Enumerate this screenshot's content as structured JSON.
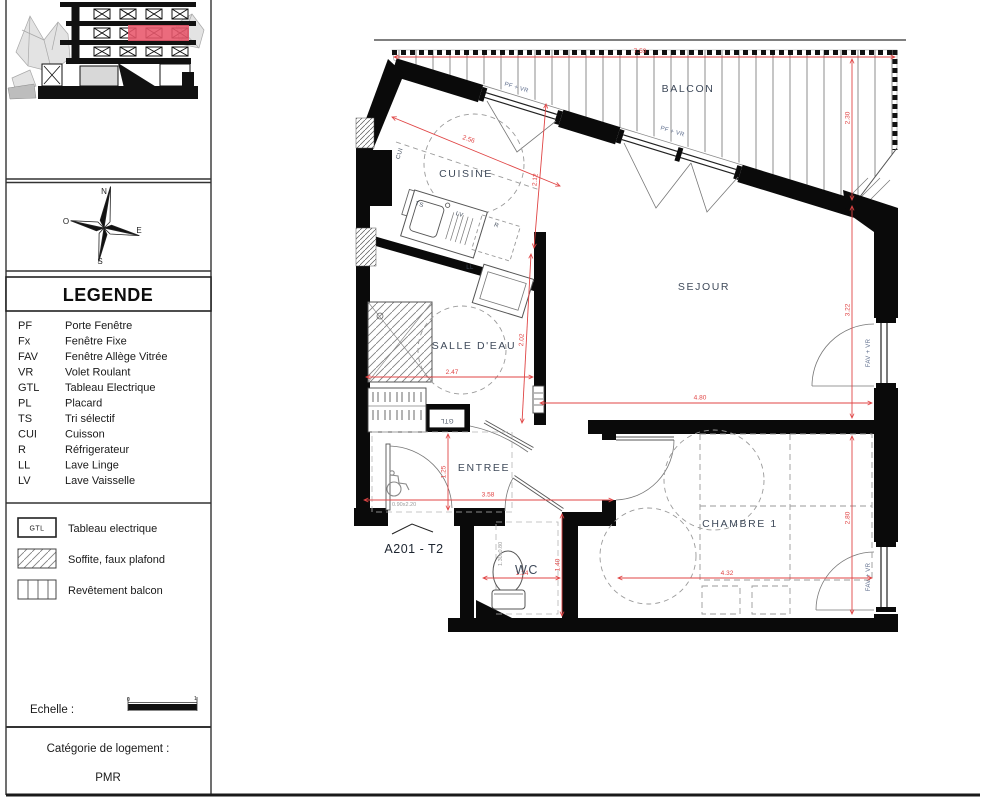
{
  "sidebar": {
    "compass": {
      "n": "N",
      "e": "E",
      "s": "S",
      "o": "O"
    },
    "legend": {
      "title": "LEGENDE",
      "items": [
        {
          "abbr": "PF",
          "label": "Porte Fenêtre"
        },
        {
          "abbr": "Fx",
          "label": "Fenêtre Fixe"
        },
        {
          "abbr": "FAV",
          "label": "Fenêtre Allège Vitrée"
        },
        {
          "abbr": "VR",
          "label": "Volet Roulant"
        },
        {
          "abbr": "GTL",
          "label": "Tableau Electrique"
        },
        {
          "abbr": "PL",
          "label": "Placard"
        },
        {
          "abbr": "TS",
          "label": "Tri sélectif"
        },
        {
          "abbr": "CUI",
          "label": "Cuisson"
        },
        {
          "abbr": "R",
          "label": "Réfrigerateur"
        },
        {
          "abbr": "LL",
          "label": "Lave Linge"
        },
        {
          "abbr": "LV",
          "label": "Lave Vaisselle"
        }
      ],
      "symbols": [
        {
          "key": "GTL",
          "label": "Tableau electrique"
        },
        {
          "key": "hatch",
          "label": "Soffite, faux plafond"
        },
        {
          "key": "stripes",
          "label": "Revêtement balcon"
        }
      ]
    },
    "scale": {
      "label": "Echelle :",
      "tick_start": "0",
      "tick_end": "1"
    },
    "category": {
      "label": "Catégorie de logement :",
      "value": "PMR"
    }
  },
  "plan": {
    "unit": "A201 - T2",
    "rooms": {
      "balcon": "BALCON",
      "cuisine": "CUISINE",
      "sejour": "SEJOUR",
      "salle_deau": "SALLE D'EAU",
      "entree": "ENTREE",
      "wc": "WC",
      "chambre": "CHAMBRE 1"
    },
    "fixtures": {
      "cui": "CUI",
      "ts": "TS",
      "lv": "LV",
      "r": "R",
      "ll": "LL",
      "gtl": "GTL"
    },
    "windows": {
      "nw": "PF + VR",
      "ne": "PF + VR",
      "sejour_east": "FAV + VR",
      "chambre_east": "FAV + VR"
    },
    "dims": {
      "balcony_width": "7.59",
      "balcony_depth": "2.30",
      "kitchen_diag": "2.56",
      "kitchen_depth": "2.12",
      "bath_depth": "2.02",
      "bath_width": "2.47",
      "sejour_width": "4.80",
      "sejour_depth": "3.22",
      "entree_width": "3.58",
      "entree_depth": "1.25",
      "wc_width": "1.34",
      "wc_depth": "1.40",
      "chambre_width": "4.32",
      "chambre_depth": "2.80"
    },
    "door_sizes": {
      "entrance": "0.90x2.20",
      "wc": "1.30x0.80"
    },
    "colors": {
      "dimension": "#e04545",
      "wall": "#0a0a0a",
      "room_label": "#3f4a5a",
      "window_label": "#5a6a8a"
    }
  }
}
